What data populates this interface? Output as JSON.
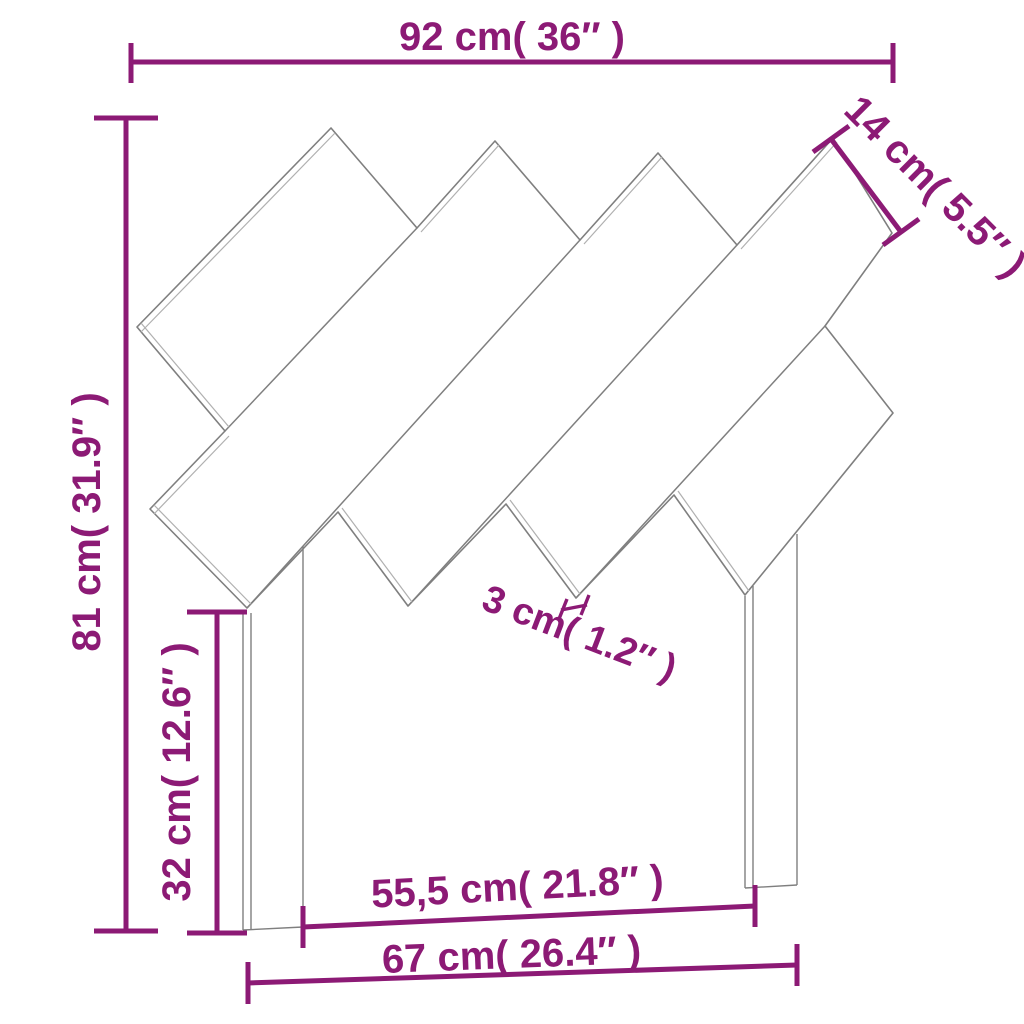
{
  "page": {
    "type": "product-dimension-diagram",
    "subject": "headboard with diagonal slats and two legs",
    "background": "#ffffff"
  },
  "colors": {
    "dimension": "#8C1A75",
    "outline": "#7f7f7f",
    "outline_light": "#b0b0b0",
    "background": "#ffffff"
  },
  "dimensions": {
    "overall_width": {
      "label": "92 cm( 36″ )",
      "measures": "total width, top edge"
    },
    "slat_width": {
      "label": "14 cm( 5.5″ )",
      "measures": "diagonal slat width, top right"
    },
    "overall_height": {
      "label": "81 cm( 31.9″ )",
      "measures": "total height, left side"
    },
    "leg_height": {
      "label": "32 cm( 12.6″ )",
      "measures": "leg height, inner left"
    },
    "slat_thickness": {
      "label": "3 cm( 1.2″ )",
      "measures": "slat board thickness, center"
    },
    "inner_leg_span": {
      "label": "55,5 cm( 21.8″ )",
      "measures": "span between legs, inner"
    },
    "outer_leg_span": {
      "label": "67 cm( 26.4″ )",
      "measures": "span across legs, outer"
    }
  }
}
